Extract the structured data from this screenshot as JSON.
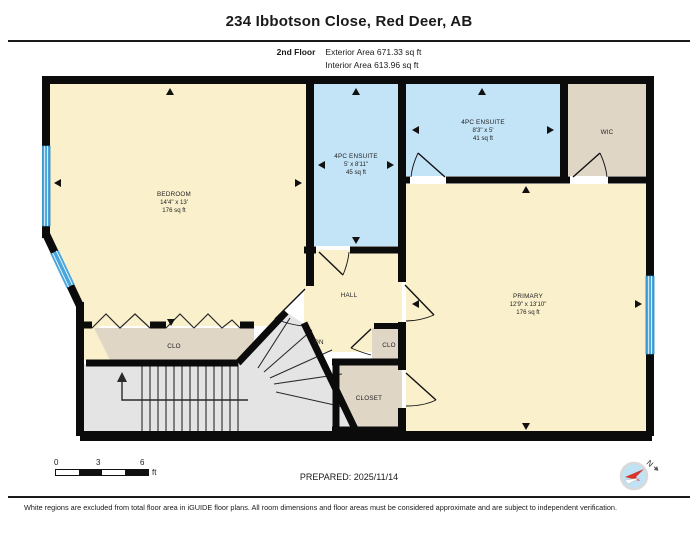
{
  "header": {
    "title": "234 Ibbotson Close, Red Deer, AB",
    "floor_label": "2nd Floor",
    "exterior_area": "Exterior Area 671.33 sq ft",
    "interior_area": "Interior Area 613.96 sq ft"
  },
  "plan": {
    "rooms": {
      "bedroom": {
        "name": "BEDROOM",
        "dims": "14'4\" x 13'",
        "area": "176 sq ft"
      },
      "ensuite_middle": {
        "name": "4PC ENSUITE",
        "dims": "5' x 8'11\"",
        "area": "45 sq ft"
      },
      "ensuite_top": {
        "name": "4PC ENSUITE",
        "dims": "8'3\" x 5'",
        "area": "41 sq ft"
      },
      "wic": {
        "name": "WIC"
      },
      "primary": {
        "name": "PRIMARY",
        "dims": "12'9\" x 13'10\"",
        "area": "176 sq ft"
      },
      "hall": {
        "name": "HALL"
      },
      "stairs": {
        "label": "DN"
      },
      "closet_bedroom": {
        "name": "CLO"
      },
      "closet_hall": {
        "name": "CLO"
      },
      "closet_primary": {
        "name": "CLOSET"
      }
    }
  },
  "footer": {
    "scale": {
      "tick0": "0",
      "tick1": "3",
      "tick2": "6",
      "unit": "ft"
    },
    "prepared": "PREPARED: 2025/11/14",
    "compass_label": "N",
    "disclaimer": "White regions are excluded from total floor area in iGUIDE floor plans. All room dimensions and floor areas must be considered approximate and are subject to independent verification."
  },
  "colors": {
    "room_cream": "#FAF0CC",
    "room_blue": "#C3E3F7",
    "room_tan": "#DFD6C6",
    "stairs_gray": "#E4E4E4",
    "wall_black": "#0B0B0B",
    "window_blue": "#4BA6DB",
    "compass_red": "#D9342B"
  }
}
